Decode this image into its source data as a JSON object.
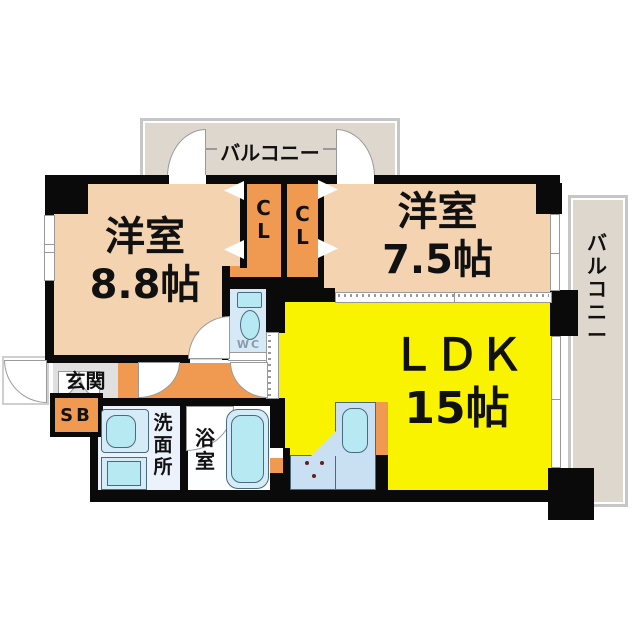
{
  "colors": {
    "wall": "#0a0a0a",
    "peach": "#f4d3b1",
    "orange": "#ef9a50",
    "yellow": "#faf300",
    "balcony-fill": "#ded7cd",
    "balcony-frame": "#c6c6c6",
    "genkan": "#e0e0e0",
    "wc-floor": "#d5e9f7",
    "washroom-floor": "#ebf2fb",
    "bath-floor": "#fdfeff",
    "fixture": "#b7e9f2",
    "fixture-light": "#d6ebf8",
    "counter": "#c9dff2",
    "stove-dot": "#6b1d1d",
    "wc-text": "#8c9bab",
    "line": "#999999"
  },
  "rooms": {
    "balcony_top": {
      "label": "バルコニー"
    },
    "balcony_right": {
      "label": "バルコニー"
    },
    "bedroom_left": {
      "name": "洋室",
      "size": "8.8帖"
    },
    "bedroom_right": {
      "name": "洋室",
      "size": "7.5帖"
    },
    "ldk": {
      "name": "ＬＤＫ",
      "size": "15帖"
    },
    "closet_left": {
      "label": "CL"
    },
    "closet_right": {
      "label": "CL"
    },
    "entrance": {
      "label": "玄関"
    },
    "shoe_box": {
      "label": "SB"
    },
    "washroom": {
      "label": "洗面所"
    },
    "bathroom": {
      "label": "浴室"
    },
    "toilet": {
      "label": "WC"
    }
  }
}
